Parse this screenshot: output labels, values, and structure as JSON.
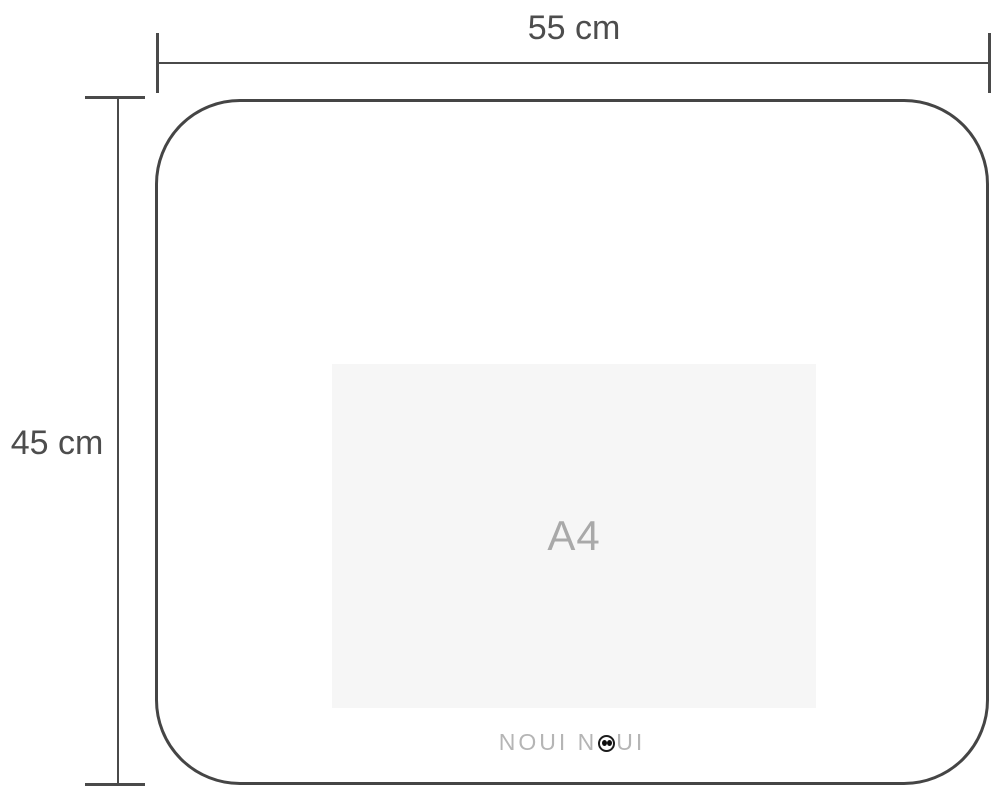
{
  "diagram": {
    "title": "placemat-dimension-diagram",
    "dimensions": {
      "width_label": "55 cm",
      "height_label": "45 cm"
    },
    "size_reference": {
      "label": "A4"
    },
    "logo": {
      "text": "NOUI NOUI",
      "part1": "NOUI N",
      "part2": "UI"
    },
    "colors": {
      "background": "#ffffff",
      "outline_line": "#454545",
      "dimension_line": "#4a4a4a",
      "dimension_text": "#4d4d4d",
      "a4_fill": "#f6f6f6",
      "a4_text": "#a9a9a9",
      "logo_text": "#b5b5b5",
      "logo_eye": "#0d0d0d"
    }
  }
}
